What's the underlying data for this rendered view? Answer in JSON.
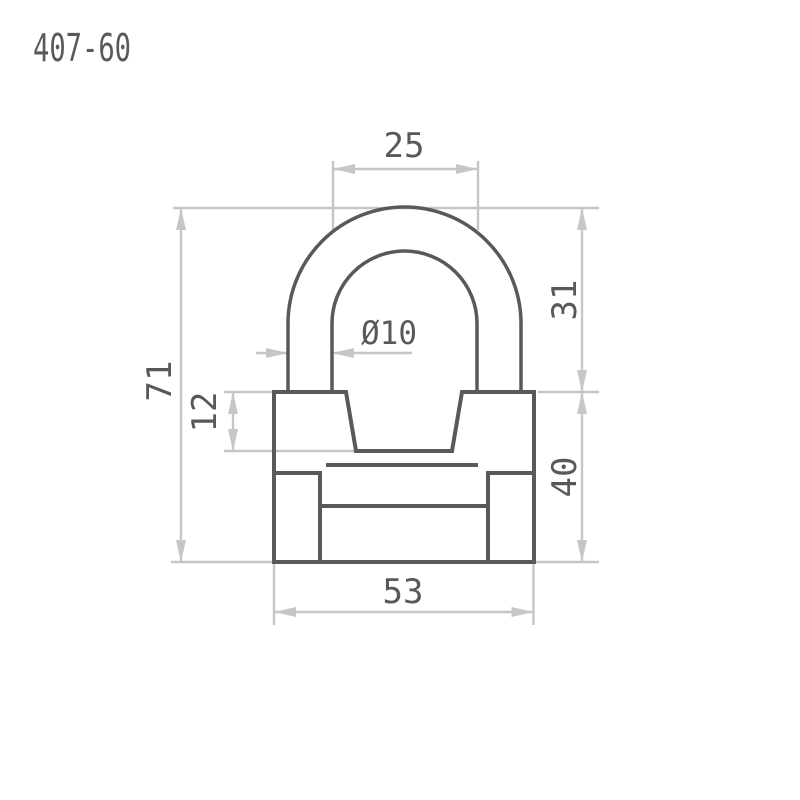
{
  "title": "407-60",
  "colors": {
    "line": "#58595b",
    "dimension": "#c6c6c6",
    "background": "#ffffff"
  },
  "drawing": {
    "object": "padlock-front-view-technical-drawing",
    "dimensions": {
      "shackle_inner_width": "25",
      "shackle_diameter": "Ø10",
      "overall_height": "71",
      "shackle_leg_visible": "12",
      "shackle_height": "31",
      "body_height": "40",
      "body_width": "53"
    }
  }
}
